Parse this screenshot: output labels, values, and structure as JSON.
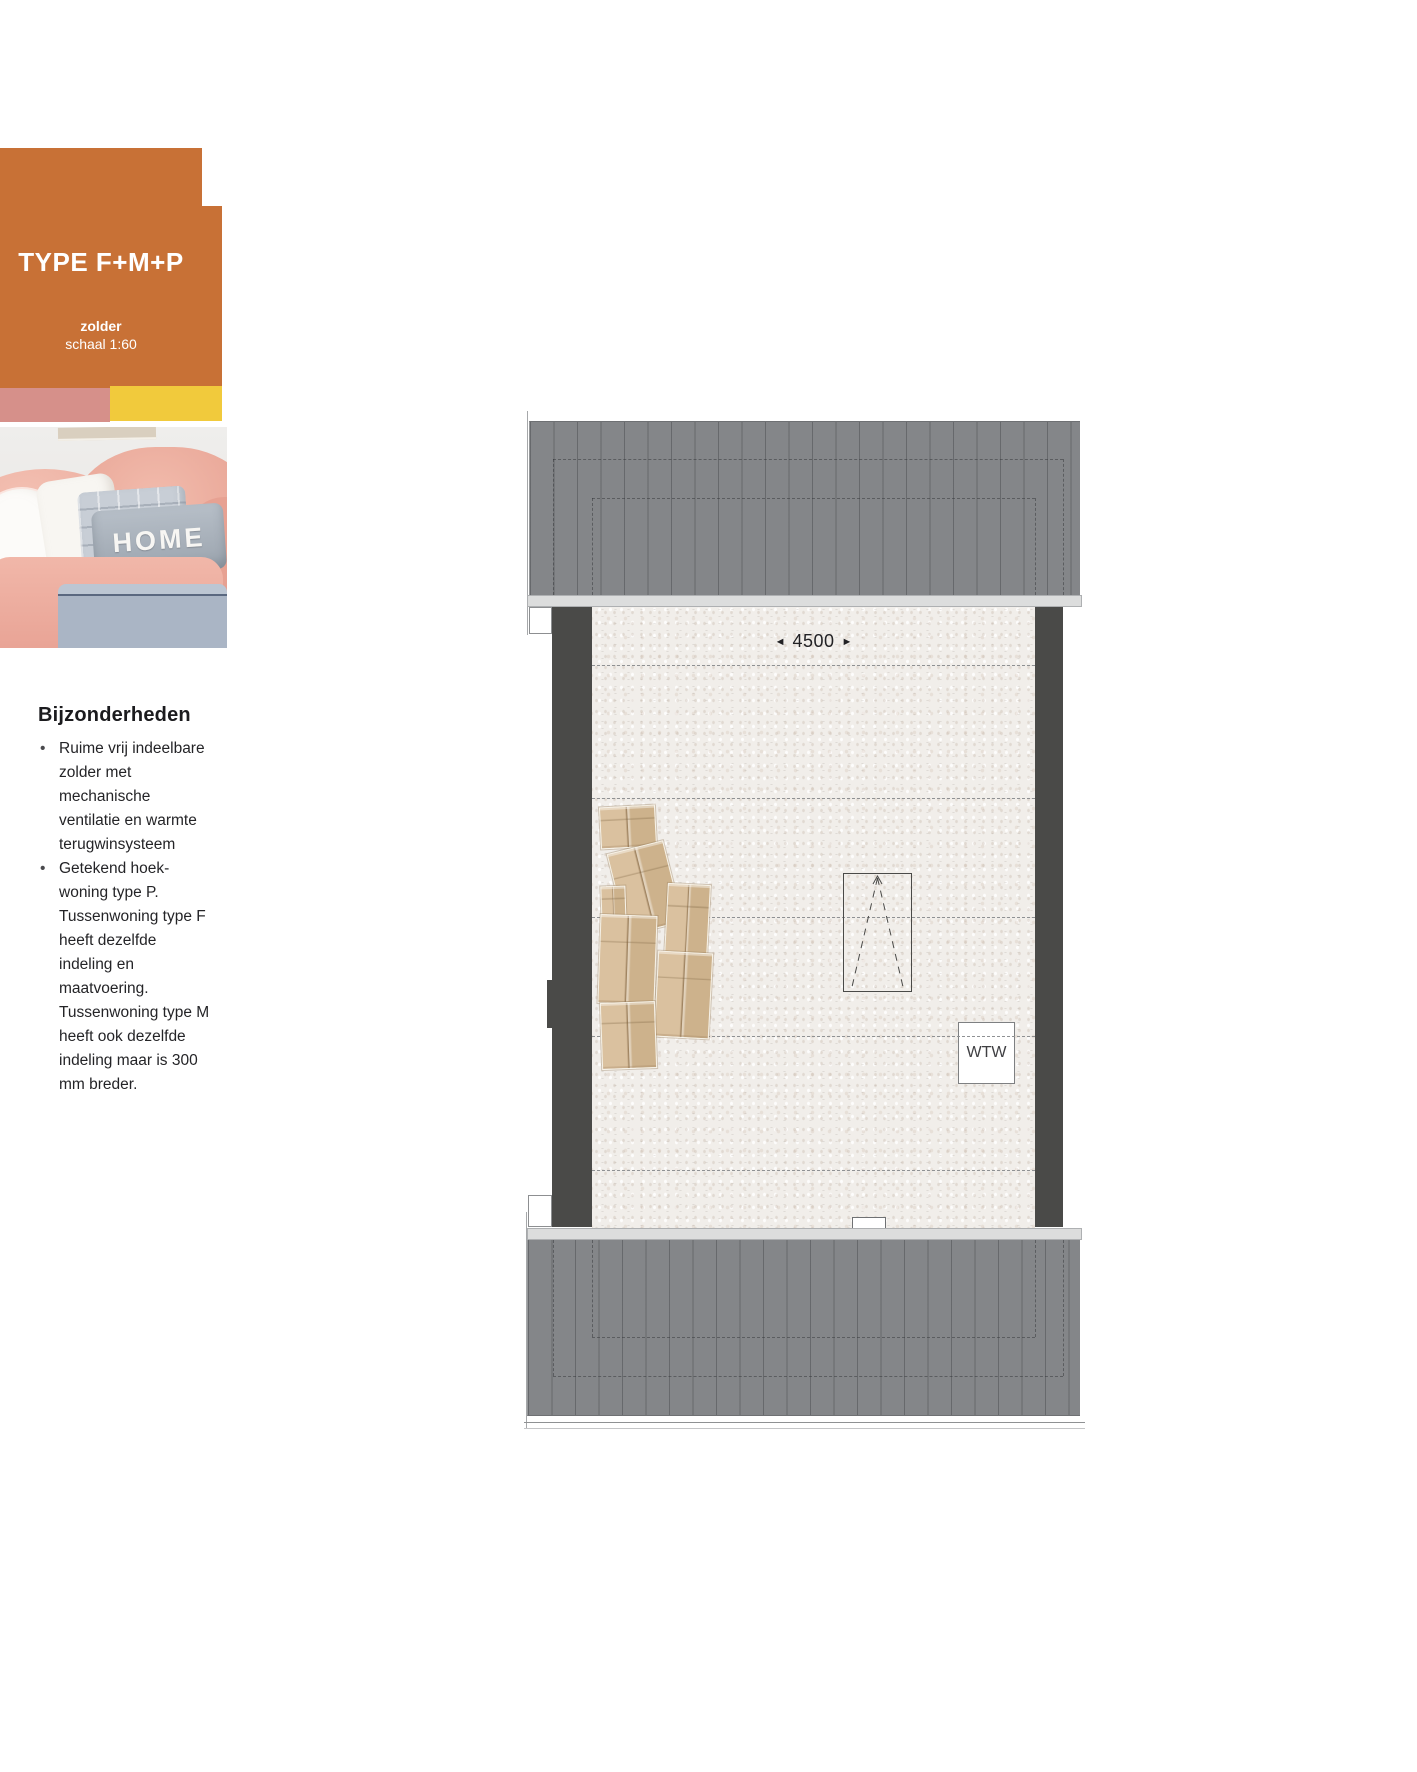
{
  "header": {
    "type_label": "TYPE F+M+P",
    "floor_label": "zolder",
    "scale_label": "schaal 1:60"
  },
  "photo": {
    "pillow_text": "HOME"
  },
  "details": {
    "heading": "Bijzonderheden",
    "bullets": [
      "Ruime vrij indeelbare zolder met mechanische ventilatie en warmte terugwinsysteem",
      "Getekend hoek-woning type P. Tussenwoning type F heeft dezelfde indeling en maatvoering. Tussenwoning type M heeft ook dezelfde indeling maar is 300 mm breder."
    ]
  },
  "plan": {
    "dimension_label": "4500",
    "arrow_left": "◄",
    "arrow_right": "►",
    "wtw_label": "WTW",
    "colors": {
      "accent_orange": "#C87136",
      "accent_pink": "#D6908A",
      "accent_yellow": "#F1CA3C",
      "roof_gray": "#848689",
      "wall_dark": "#4A4A48",
      "floor_tint": "#F1EEEA"
    },
    "furniture_boxes": [
      {
        "x": 600,
        "y": 806,
        "w": 56,
        "h": 42,
        "rot": -3
      },
      {
        "x": 616,
        "y": 846,
        "w": 58,
        "h": 84,
        "rot": -14
      },
      {
        "x": 666,
        "y": 884,
        "w": 43,
        "h": 73,
        "rot": 3
      },
      {
        "x": 601,
        "y": 886,
        "w": 25,
        "h": 40,
        "rot": -2
      },
      {
        "x": 599,
        "y": 915,
        "w": 57,
        "h": 89,
        "rot": 2
      },
      {
        "x": 656,
        "y": 952,
        "w": 55,
        "h": 86,
        "rot": 3
      },
      {
        "x": 601,
        "y": 1002,
        "w": 55,
        "h": 67,
        "rot": -2
      }
    ]
  }
}
